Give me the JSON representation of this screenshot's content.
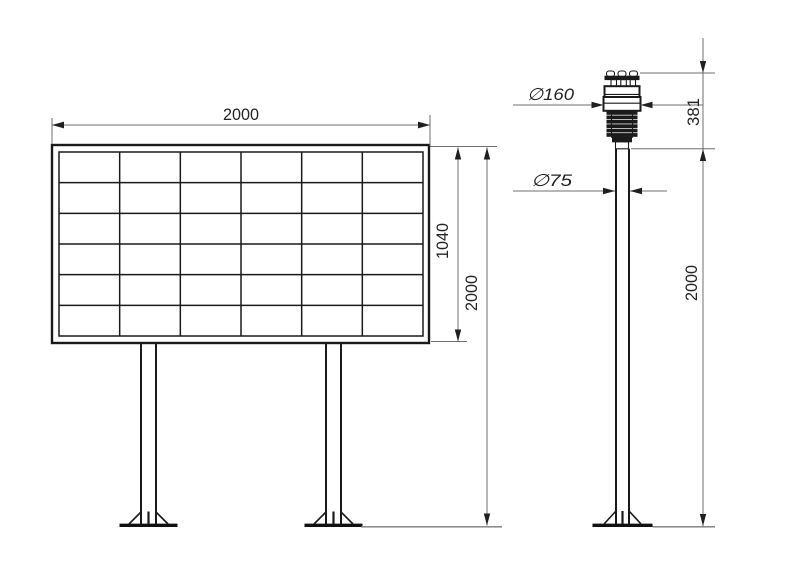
{
  "colors": {
    "background": "#ffffff",
    "object_line": "#1a1a1a",
    "dimension_line": "#6f6f6f",
    "text": "#242424"
  },
  "board_view": {
    "grid": {
      "rows": 6,
      "cols": 6
    },
    "dims": {
      "width": "2000",
      "panel_height": "1040",
      "overall_height": "2000"
    }
  },
  "station_view": {
    "dims": {
      "head_diameter": "∅160",
      "head_height": "381",
      "pole_diameter": "∅75",
      "pole_height": "2000"
    }
  }
}
